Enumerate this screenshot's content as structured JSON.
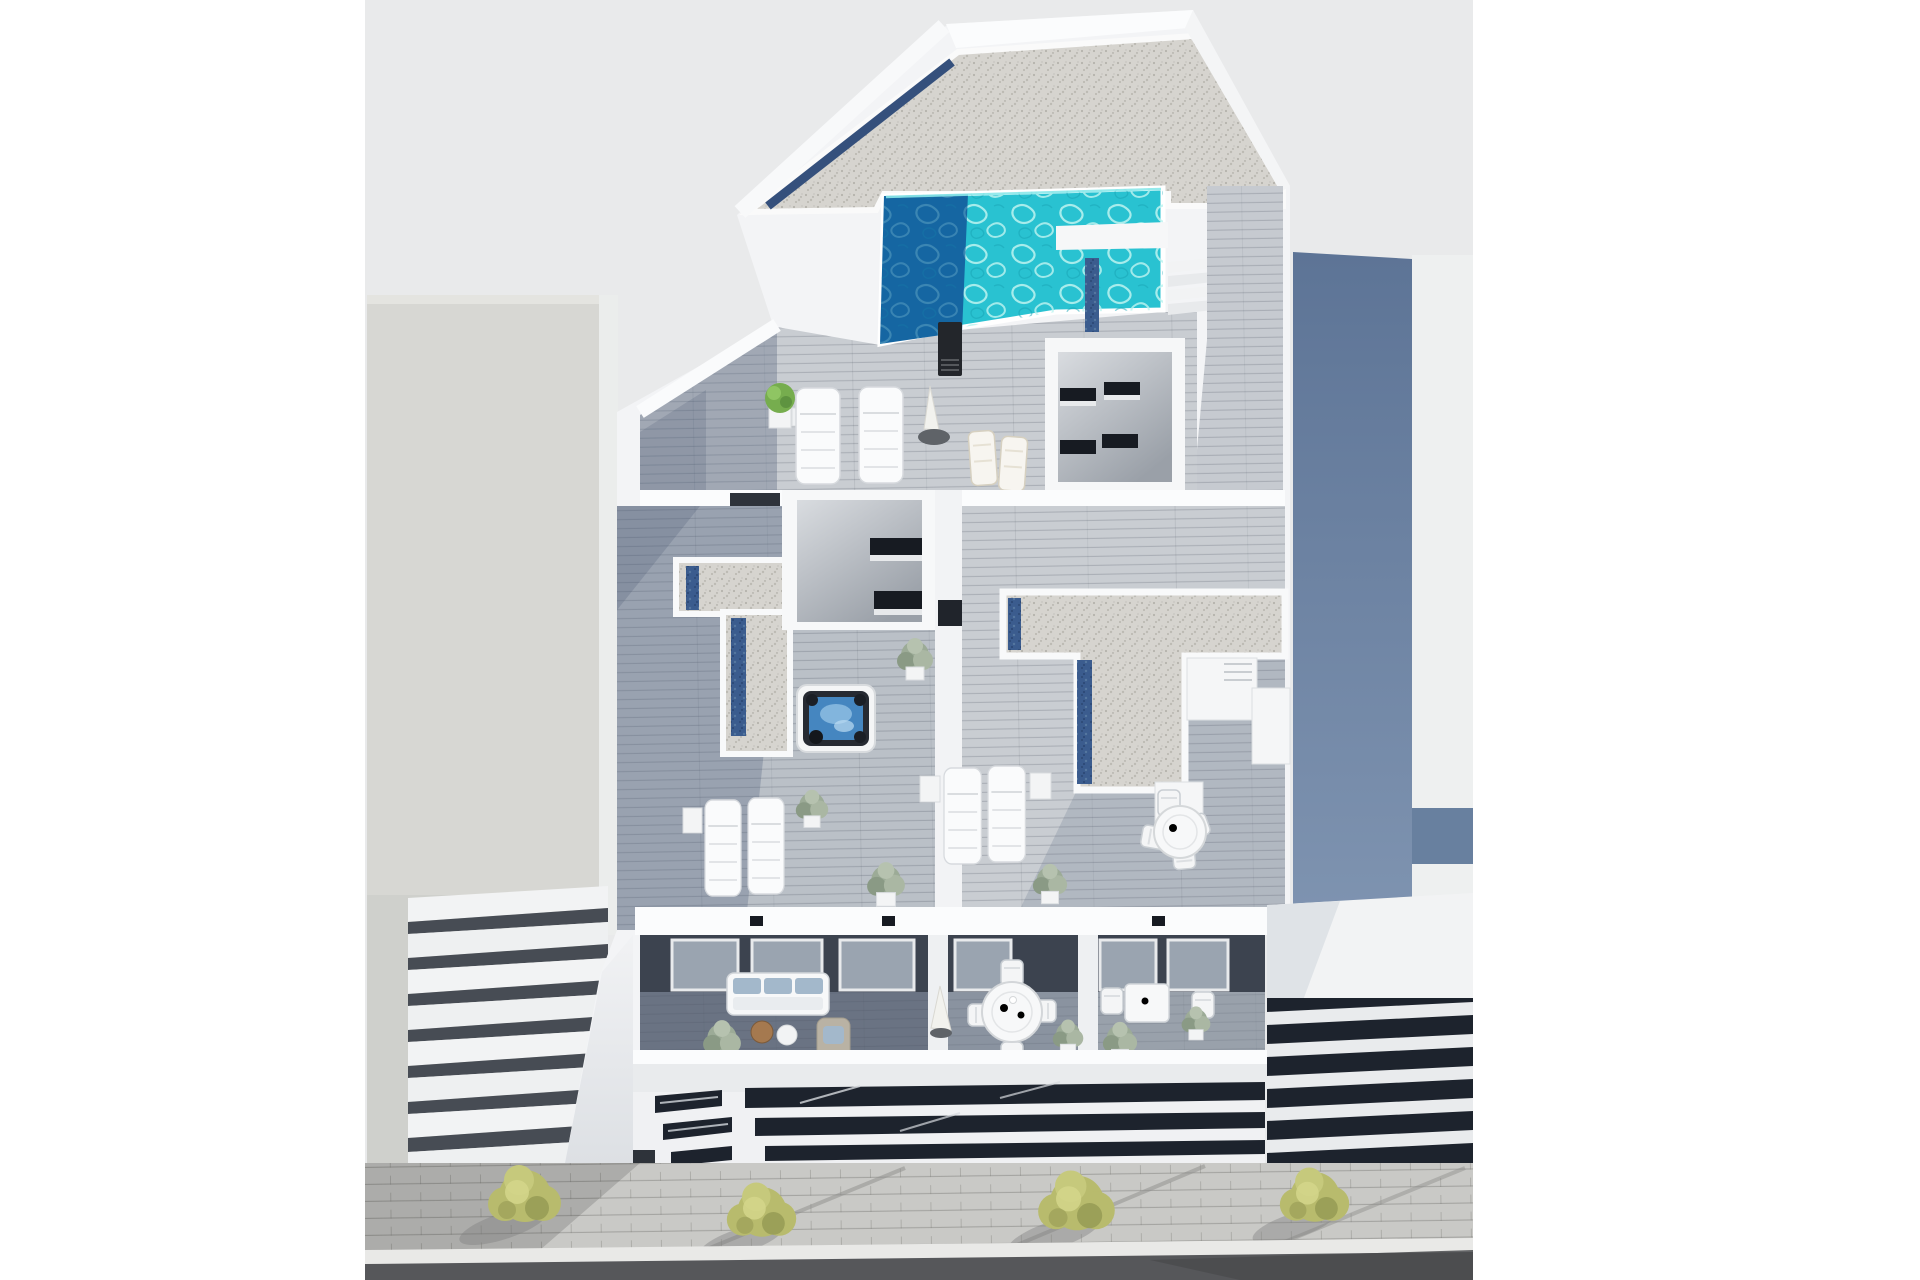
{
  "image": {
    "type": "3d-architectural-render",
    "description": "Aerial 3D render of a modern white apartment building: rooftop terrace with turquoise swimming pool, gravel flat roofs with blue skylight strips, jacuzzi, sun loungers, lower balconies with outdoor furniture, neighboring buildings and a street with trees below",
    "width_px": 1920,
    "height_px": 1280
  },
  "scene": {
    "objects": [
      "rooftop-swimming-pool",
      "pool-stairs",
      "wood-deck-walkway",
      "outdoor-shower-column",
      "sun-loungers",
      "folding-deck-chairs",
      "closed-parasol",
      "potted-plants",
      "stairwell-enclosure",
      "courtyard-room",
      "gravel-roof",
      "skylight-strips",
      "jacuzzi-hot-tub",
      "round-dining-table",
      "bistro-table",
      "outdoor-sofa",
      "coffee-tables",
      "wicker-chair",
      "balconies",
      "louvered-vents",
      "left-neighbor-building",
      "right-neighbor-building",
      "stepped-balconies",
      "sidewalk",
      "street-trees",
      "curb",
      "asphalt-road"
    ]
  },
  "colors": {
    "margin_white": "#ffffff",
    "backdrop_gray": "#e9eaeb",
    "building_white": "#f3f4f6",
    "parapet_white": "#fbfcfd",
    "shadow_white": "#dfe2e6",
    "neighbor_left_wall": "#d7d7d3",
    "neighbor_left_edge": "#ebedec",
    "step_gap_dark": "#474c54",
    "neighbor_right_sunlit": "#eef0f0",
    "facade_navy": "#1d232d",
    "slat_white": "#e9ebed",
    "pool_turquoise": "#29c2d1",
    "pool_deep": "#1566a2",
    "pool_rim": "#ffffff",
    "solar_blue": "#3b5c8e",
    "gravel": "#d6d4cf",
    "wood_light": "#c9cdd2",
    "wood_mid": "#bac0c7",
    "wood_walkway": "#c6cad0",
    "terrace_shadow": "#55647e",
    "balcony_wall_dark": "#3c434f",
    "balcony_glass": "#9aa4b0",
    "balcony_floor_dark": "#6a7383",
    "balcony_floor_mid": "#8a93a0",
    "balcony_floor_light": "#99a1ab",
    "furniture_white": "#f7f8f9",
    "furniture_stroke": "#d2d6da",
    "sofa_cushion": "#a3b8cb",
    "wicker": "#b9b2a4",
    "table_wood": "#a5794f",
    "jacuzzi_shell": "#262a32",
    "jacuzzi_water": "#4586c0",
    "glass_dark": "#171b22",
    "plant_green": "#76ad4e",
    "plant_gray_green": "#9cab97",
    "tree_olive": "#b8bb6d",
    "tree_olive_light": "#d4d68b",
    "tree_olive_dark": "#8f9450",
    "sidewalk": "#c9c9c6",
    "sidewalk_shadow": "#8e8e8c",
    "curb": "#e9e9e7",
    "road": "#56575a",
    "road_dark": "#4a4b4e",
    "umbrella_base": "#5f6368"
  }
}
